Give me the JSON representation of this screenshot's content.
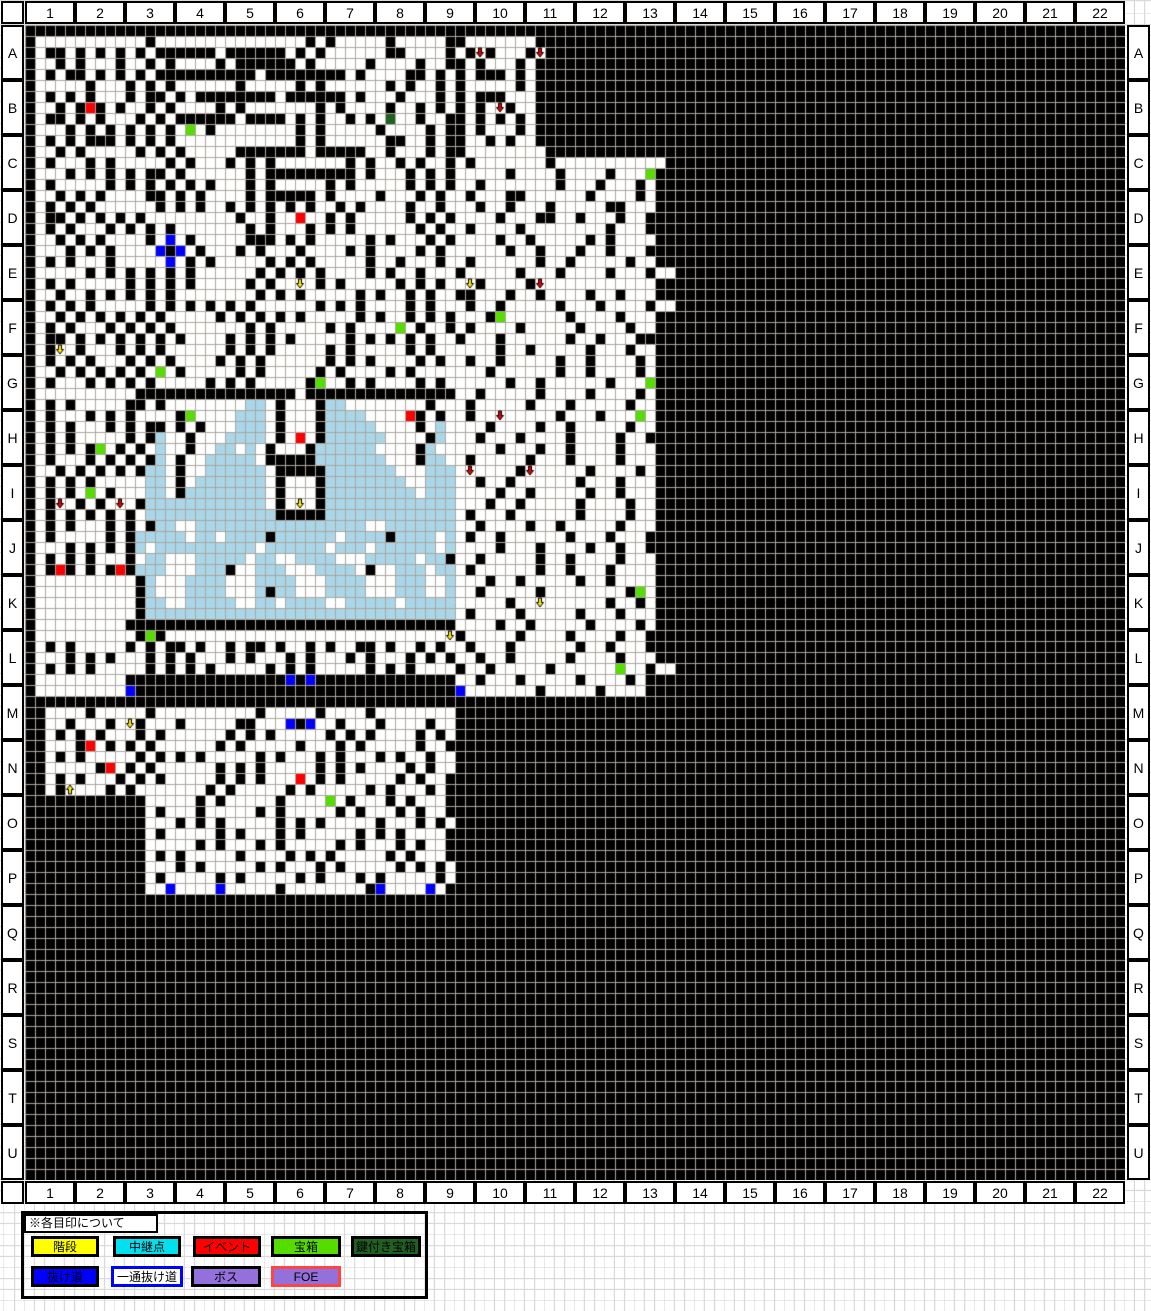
{
  "map": {
    "column_headers": [
      "1",
      "2",
      "3",
      "4",
      "5",
      "6",
      "7",
      "8",
      "9",
      "10",
      "11",
      "12",
      "13",
      "14",
      "15",
      "16",
      "17",
      "18",
      "19",
      "20",
      "21",
      "22"
    ],
    "row_headers": [
      "A",
      "B",
      "C",
      "D",
      "E",
      "F",
      "G",
      "H",
      "I",
      "J",
      "K",
      "L",
      "M",
      "N",
      "O",
      "P",
      "Q",
      "R",
      "S",
      "T",
      "U"
    ],
    "grid": {
      "width": 110,
      "height": 105,
      "cell_width": 10,
      "cell_height": 11,
      "palette": {
        "#": "#000000",
        ".": "#FFFFFF",
        "w": "#A9D6E8",
        "R": "#FF0000",
        "G": "#55DD00",
        "D": "#206020",
        "B": "#0000FF"
      },
      "arrows": {
        "y": {
          "fill": "#FFE800",
          "dir": "down"
        },
        "u": {
          "fill": "#FFE800",
          "dir": "up"
        },
        "r": {
          "fill": "#E60000",
          "dir": "down"
        }
      },
      "grid_line_color": "#ACA69E",
      "rows_rle": [
        "#110",
        "#1.11#1.15#1.1#1.5#1.5#1#1.7#12#47",
        "#1.1#2.1#1.1#1.1#1.1#1.1#6.1#6.1#1.1#1.6#2.4#1.1#1r1#1.3#1r1#12#47",
        "#1.2#1.1#1.3#1.2#1.1#1.4#1.1#6.1#1.5#1.4#1.2#1#1.1#1.3#1.1#12#47",
        "#1.1#1.1#2.1#1.1#1.1#1.1#10.1#8.1#1.4#2.1#1.1#1.1#3.1#1.1#12#47",
        "#1.5#1.3#1.1#1.1#1.6#1.5#1.1#1.6#1.1#1.2#1.1#1.5#1.1#12#47",
        "#1.1#1.1#1.1#1.3#1.1#2.1#1.1#8.1#6.1#1.3#1.3#1.1#1.1#3.3#12#47",
        "#1.2#1.1#1R1#1.1#1.2#1.1#1.4#1.1#1.7#1.1#1.4#1.2#1.1#1.1#1.1#1.1r1#1.2#12#47",
        "#1.1#2.1#1.1#1.3#1.1#1.1#6.1#4.1#1.1#1.2#1.1#1.1D1.2#1.2#1#1.1#1.1#1.1#1.1#12#47",
        "#1.3#1.1#1.1#1.1#1.1#1.1#1.1G1.1#1.8#1.1#1.5#1.4#1.1#1#1.1#1.3#1.1#12#47",
        "#1.1#1.1#1.1#3.1#1.1#1.1#1.12#1.1#1.6#2.2#1.1#1#1.2#1.1#1.2#12#47",
        "#1.2#1.1#1.5#1.1#1.1#1.5#7.1#5.2#1.3#1.1#1#1.8#11#47",
        "#1.1#1.3#1.1#1.5#1.1#1.3#1.1#1.1#1.7#1.1#1.2#1.1#1.2#1.1#1.7#1.11#47",
        "#1.3#1.1#1.1#1.1#1.1#2.1#1.6#1.1#9.1#1.3#1.1#1.1#1.5#1.4#1.4#1.3G1#47",
        "#1.1#1.5#1.1#1.1#1.1#1.1#1.1#1.3#1.1#1.5#1.1#1.5#1.1#1.1#1.2#1.7#1.3#1.3#1.1#47",
        "#1.2#1.1#1.1#1.4#2.1#1.1#1.4#1.1#5.1#1.4#1.3#1.1#1.1.1#1.3#2.6#1.4#1.1#47",
        "#1.1#1.1#1.1#1.6#1.1#1.1#1.2#1.1#1.1#1.1#1.1#1.2#1.1#1.4#1.2#1.1.2#1.2#1.3#1.5#2.3#47",
        "#1.1#2.1#1.1#1.1#1.1#1.9#1.2#1.2R1.2#1.1#1.5#1.1#1.1#1.4#1.3#2.2#1.3#1.2#1#47",
        "#1.1#1.1#1.3#1.1#1.1#1.1#1.7#1.1#1.3#1.1#1.1#1.6#1.1#1.1.1#1.4#1.8#1.3#1#47",
        "#1.2#1.1#1.1#1.4#1.1B1.1#1.5#3.1#1.1#1.5#1.1#1.3#1.1#1.1.3#1.2#1.5#1.1#1.4#1#47",
        "#1.3#1.1#1.1#1.4B1#1B1.1#1.3#1.1#1.3#1.4#1.1#1.4#1.1#1.1.5#1.2#1.3#1.2#1.3#1#47",
        "#1.1#1.1#1.3#1.5B1.1#1.1#1.5#1.1#1.1#1.5#1.2#1.3#1.1.1#1.6#1.2#1.5#1.2#47",
        "#1.5#1.1#1.1#1.1#1.1#1.1#1.6#1.1#1.1#1.1#1.4#1.1#1.2#1.3#1.1.4#1.3#1.4#1.3#1.2#47",
        "#1.1#1.1#1.5#1.1#1.1#1.1#1.5#1.1#1.2y1.1#1.1#1.5#1.1#1.1#1.1.1y1#1.4#1r1.11#47",
        "#1.2#1.2#1.1#1.1#1.1#1.1#1.8#1.1#1.1#1.5#1.1#1.2#1.1#1.2#1#1.3#1.2#1.4#1.2#1.3#1#47",
        "#1.1#1.1#1.1#1.5#1.1#1.1#1.1#1.1#1.1#1.6#1.1#1.1#1.4#1.1#1.3#1.2#1.5#1.3#1.4#1.2#47",
        "#1.2#1.1#1.1#1.1#1.1#1.1#1.5#1.1#1.1#1.1#1.1#1.5#1.1#1.2#1.1#1.1#1.3#1G1.6#1.4#1.3#47",
        "#1.1#1.1#1.3#1.1#1.1#1.1#1.7#1.1#1.5#1.1#1.4G1.1#1.2#1.1#1.4#1.5#1.4#1.2#47",
        "#1.1#2.1#1.1#1.1#1.1#1.1#1.1#1.4#1.1#1.1#1.1#1.5#1.1#1.1#1.1#1.1#1.2#1.3#1.6#1.2#1.3#47",
        "#1.1#1y1.1#1.3#1.1#1.1#1.6#1.1#1.1#1.5#1.1#1.5#1.1#1.2.4#1.2#1.5#1.3#1.2#47",
        "#1.1#1.1#1.1#1.3#1.1#1.1#1.4#1.1#1.1#1.6#1.1#1.1#1.4#1.1#1.1.1#1.2#1.5#1.2#1.4#1.1#47",
        "#1.2#1.1#1.1#1.1#1.1#1.1G1.1#1.5#1.1#1.5#1.1#1.4#1.1#1.4.3#1.6#1.2#1.4#1.1#47",
        "#1.1#1.3#1.1#1.1#1.1#1.5#1.1#1.1#1.5#1G1.2#1.1#1.4#1.1#1.1.5#1.2#1.6#1.3G1#47",
        "#1.10#16.1#15.2#1.5#1.4#1.4#1.1#47",
        "#1.1#1.1#1.5#2.1#1.8w2.1#1.3#1w2.8#1.2.1#1.5#1.3#1.5#1.2#47",
        "#1.1#1.3#1.1#1.1#1.4#1G1.4w3.1#1.3#1w4.4R1#1.1#1.1.1#1.2r1.5#1.3#1.3G1.1#47",
        "#1.1#1.1#1.3#1.1#1.1#2.1#1.1#1.3w3.1#1.3#1w5.4#1.1w1.1.3#1.4#1.2#1.5#1.2#47",
        "#1.1#1.1#1.5#1.1#1w1.2#1.3w4.1#1.1R1.1#1w6.4#1w1.1.2#1.3#1.4#1.4#1.2#1#47",
        "#1.1#1.1#1.1#1G1.1#1.1#1.1w1.2#1.2w2.1w1.1#1.3#1w6.4#1w1.2.4#1.3#1.2#1.4#1.3#47",
        "#1.1#1.3#1.1#1.1#1.1#1w1.1#1.2w5.1#5w7.3#1w2.1.1#1.5#1.3#1.4#1.3#47",
        "#1.2#1.1#1.1#1.1#1.1#1w2.1#1.2w6.1#5w7.3w3.1r1.4#1r1.5#1.4#1.1#47",
        "#1.1#1.1#1.1#1.5w2.1#1.1w7.1#1.3#1w8.2w3.2#1.2#1.6#1.3#1.3#47",
        "#1.1#1.1#1.1G1.1#1.3w2.1#1w8.1#1.3#1w9.1w3.4#1.2#1.5#1.2#1.3#47",
        "#1.1#1r1.1#1.1#1.1r1.1#1w12.1#1.1y1.1#1w13.3#1.2#1.5#1.4#1.2#47",
        "#1.1#1.1#1.1#1.1#1.1#1.1w13#5w13.1#1.3#1.6#1.4#1.2#47",
        "#1.1#1.1#1.3#1.1#1.1#1w2.2w17.2w7.2#1.4#1.2#1.5#1.3#47",
        "#1.1#1.5#1.1#1w5.1w2.1w4#1w6.1w4#1w4.1w1.1#1.2#1.6#1.3#1.3#47",
        "#1.3#1.1#1.1#1.1#1w1.1w10.1w6.1w3.1w6.1w1.4#1.3#1.4#1.2#1.2#47",
        "#1.1#1.1#1.1#1.3#1.1w2.3w5.1w2.2w4.3w5.1w2#1.2#1.5#1.2#1.4#1.3#47",
        "#1.1#1R1#1.1#1.1#1R1#1w3.3w3#1.2w3.3w4.1#1.2w3.1w2.1#1.6#1.2#1.3#1.4#47",
        "#1.10#1w1.3w4.3w4.3w4.3w3.2w1.3#1.2#1.5#1.2#1.4#47",
        "#1.10#1w1.3w4.3w1#1w2.3w4.3w3.2w1.2#1.5#1.8#1G1.1#47",
        "#1.10#1w2.2w5.2w2.1w4.2w5.1w5.5#1.2y1.6#1.2#1.1#47",
        "#1.10#1w31.1#1.4#1.5#1.3#1.3#47",
        "#1.9#33.4#1.2#1.5#1.4#1.1#47",
        "#1.10#1G1#1.28y1#1.5#1.4#1.4#1.2#1#47",
        "#1.1#1.1#1.5#1.1#1.1#2.1#1.2#1.1#2.1#1.2#1.1#1.2#2.1#1.2#1.1#1.2#1.3#1.6#1.2#1.3#47",
        "#1.3#1.1#1.1#1.3#1.1#1.1#1.3#1.1#1.3#1.1#1.3#1.1#1.3#1.1#1.1#1.1.1#1.2#1.5#1.4#1.3#1#47",
        "#1.1#1.1#1.1#1.5#1.1#1.1#1.1#1.5#1.1#1.1#1.5#1.1#1.1#1.4#1.1.1#1.5#1.6G1.2#1.2#47",
        "#1.9#16B1#1B1#14.2#1.3#1.5#1.4#1.1#1#47",
        "#1.9B1#32B1.7#1.5#1.4#1#47",
        "#110",
        "#2.4#1.5#1.10#1.5#1.4#1.8#67",
        "#2.2#1.3#1.1y1#1.3#1.5#2.3B1#1B1.2#1.3#1.4#1.2#67",
        "#2.1#1.1#1.1#1.3#1.1#1.6#1.1#1.1#1.5#1.1#1.1#1.4#1.1#1.1#67",
        "#2.3#1R1.1#1.1#1.1#1.6#1.1#1.5#1.3#1.1#1.5#1.2#1#67",
        "#2.1#1.1#1.5#1.1#1.1#1.1#1.5#1.1#1.3#1.1#1.3#1.1#1.2#1.2#67",
        "#2.5#1R1.1#1.1#1.6#1.1#1.1#1.5#1.1#1.1#1.4#1.1#1.2#67",
        "#2.1#1.1#1.3#1.1#1.1#1.5#1.1#1.1#1.3R1.1#1.1#1.5#1.1#1.2#1#67",
        "#2.1#1u1.3#1.1#1.7#1.1#1.5#1.1#1.5#1.1#1.3#1.1#1#67",
        "#12.5#1.1#1.5#1.4G1.1#1.3#1.1#1.3#1#67",
        "#12.1#1.3#1.5#1.1#1.5#1.1#1.3#1.1#1.2#1#67",
        "#12.3#1.1#1.1#1.5#1.1#1.1#1.5#1.3#1.1#1.1#67",
        "#12.1#1.5#1.1#1.3#1.1#1.5#1.1#1.1#1.4#1#67",
        "#12.5#1.1#1.3#1.1#1.5#1.1#1.3#1.1#1.2#1#67",
        "#12.1#1.1#1.5#1.4#1.1#1.1#1.5#1.1#1.3#1#67",
        "#12.3#1.1#1.5#1.1#1.3#1.1#1.5#1.1#1.1#1.1#67",
        "#12.1#1.5#1.1#1.5#1.1#1.3#1.1#1.5#1.1#67",
        "#12.2B1.4B1.5#1.8#1B1.4B1.1#1#67",
        "#110",
        "#110",
        "#110",
        "#110",
        "#110",
        "#110",
        "#110",
        "#110",
        "#110",
        "#110",
        "#110",
        "#110",
        "#110",
        "#110",
        "#110",
        "#110",
        "#110",
        "#110",
        "#110",
        "#110",
        "#110",
        "#110",
        "#110",
        "#110",
        "#110",
        "#110"
      ]
    }
  },
  "legend": {
    "title": "※各目印について",
    "items": [
      {
        "label": "階段",
        "bg": "#FFFF00",
        "border": "#000000",
        "text": "#000000"
      },
      {
        "label": "中継点",
        "bg": "#00E0EE",
        "border": "#000000",
        "text": "#000000"
      },
      {
        "label": "イベント",
        "bg": "#FF0000",
        "border": "#000000",
        "text": "#000000"
      },
      {
        "label": "宝箱",
        "bg": "#55DD00",
        "border": "#000000",
        "text": "#000000"
      },
      {
        "label": "鍵付き宝箱",
        "bg": "#206020",
        "border": "#000000",
        "text": "#000000"
      },
      {
        "label": "抜け道",
        "bg": "#0000FF",
        "border": "#000000",
        "text": "#000000"
      },
      {
        "label": "一通抜け道",
        "bg": "#FFFFFF",
        "border": "#0000FF",
        "text": "#000000"
      },
      {
        "label": "ボス",
        "bg": "#9370DB",
        "border": "#000000",
        "text": "#000000"
      },
      {
        "label": "FOE",
        "bg": "#9370DB",
        "border": "#FF4444",
        "text": "#000000"
      }
    ]
  }
}
